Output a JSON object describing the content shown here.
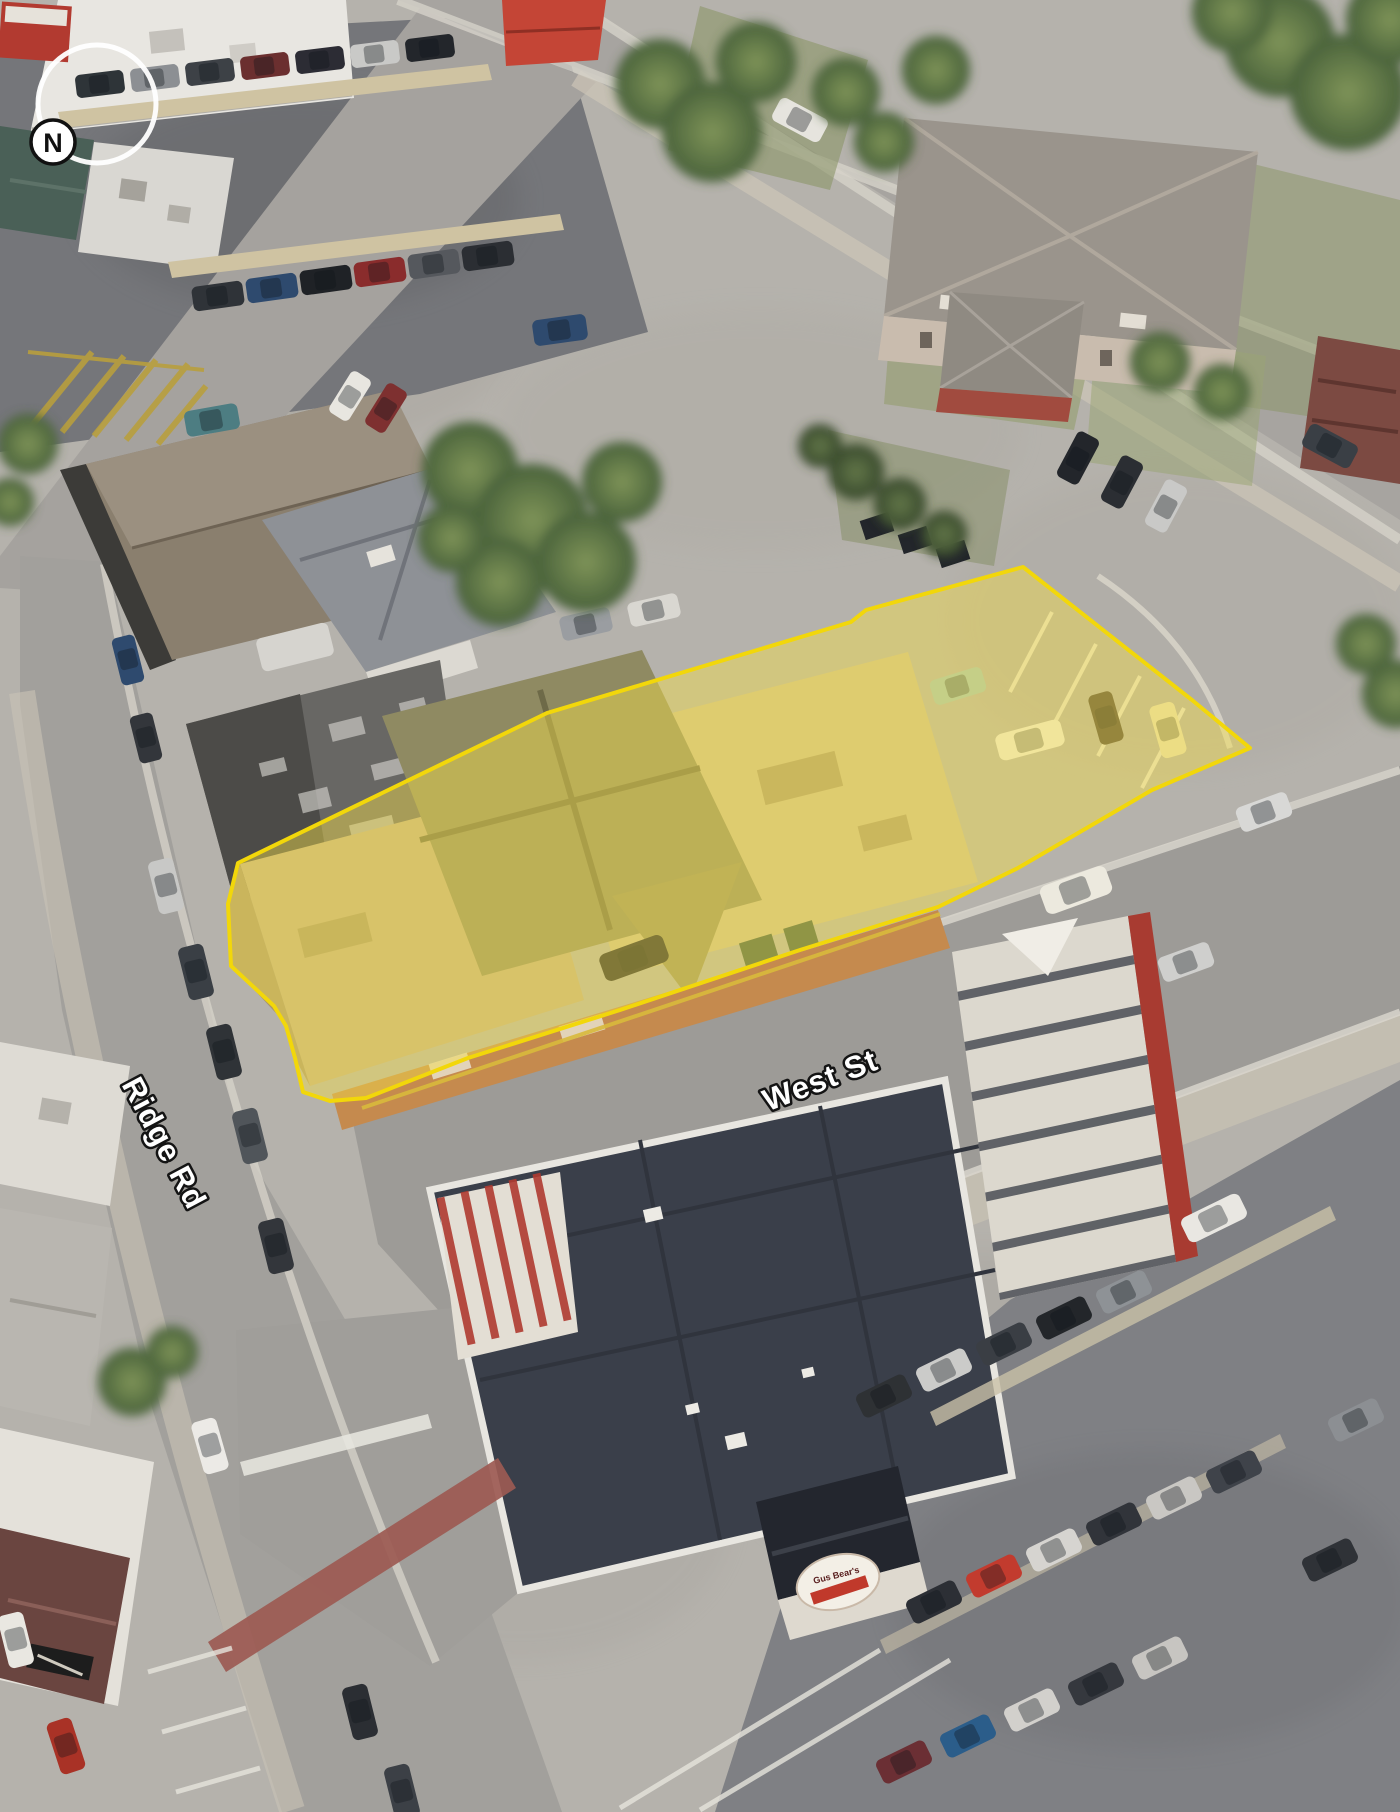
{
  "map": {
    "compass": {
      "label": "N"
    },
    "streets": [
      {
        "id": "ridge-rd",
        "label": "Ridge Rd"
      },
      {
        "id": "west-st",
        "label": "West St"
      }
    ],
    "storefront_sign": {
      "label": "Gus Bear's"
    },
    "label_style": {
      "fill": "#ffffff",
      "outline": "#141414"
    },
    "highlight": {
      "fill": "#F4DE4A",
      "fill_opacity": "0.45",
      "stroke": "#F2D70A",
      "stroke_width": "4"
    }
  }
}
